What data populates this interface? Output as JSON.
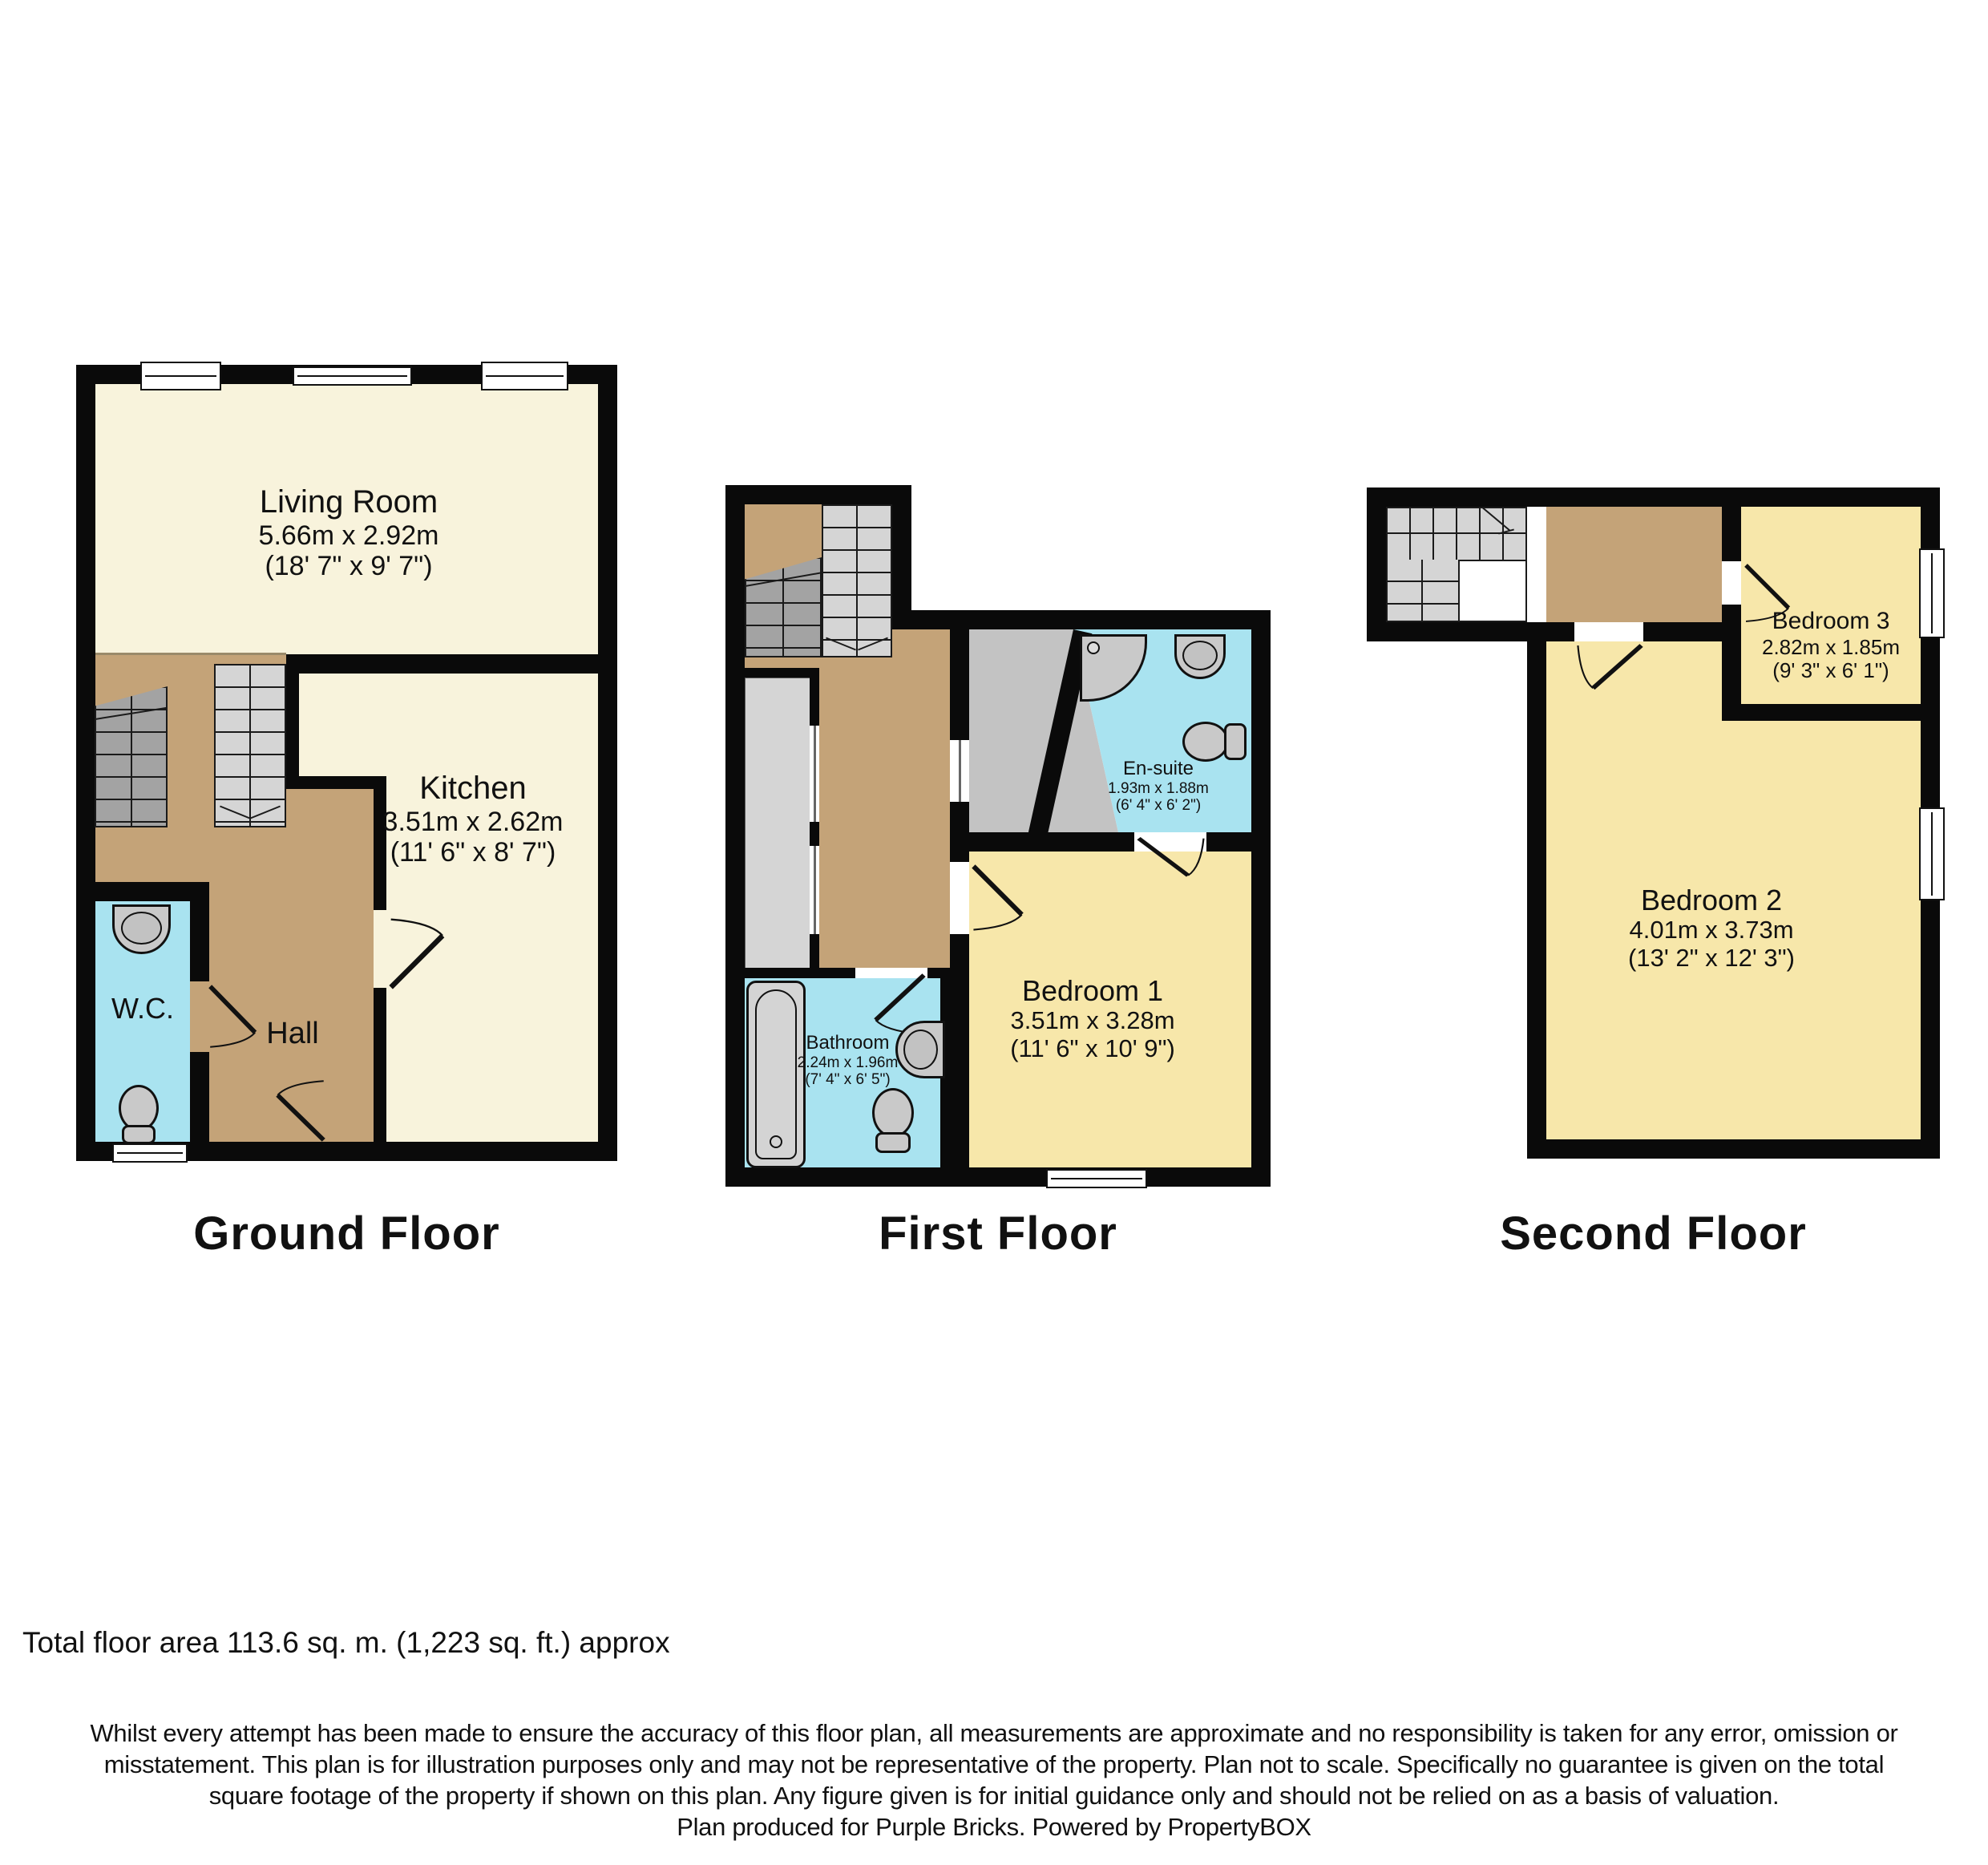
{
  "colors": {
    "wall": "#0a0a0a",
    "cream": "#F8F3DC",
    "yellow": "#F7E7AA",
    "brown": "#C4A378",
    "cyan": "#A9E3F0",
    "gray_light": "#D5D5D5",
    "gray_mid": "#C3C3C3",
    "gray_dark": "#A3A3A3",
    "fixture": "#C9C9C9"
  },
  "ground": {
    "title": "Ground Floor",
    "living": {
      "name": "Living Room",
      "m": "5.66m x 2.92m",
      "ft": "(18' 7\" x 9' 7\")"
    },
    "kitchen": {
      "name": "Kitchen",
      "m": "3.51m x 2.62m",
      "ft": "(11' 6\" x 8' 7\")"
    },
    "wc": {
      "name": "W.C."
    },
    "hall": {
      "name": "Hall"
    }
  },
  "first": {
    "title": "First Floor",
    "ensuite": {
      "name": "En-suite",
      "m": "1.93m x 1.88m",
      "ft": "(6' 4\" x 6' 2\")"
    },
    "bed1": {
      "name": "Bedroom 1",
      "m": "3.51m x 3.28m",
      "ft": "(11' 6\" x 10' 9\")"
    },
    "bath": {
      "name": "Bathroom",
      "m": "2.24m x 1.96m",
      "ft": "(7' 4\" x 6' 5\")"
    }
  },
  "second": {
    "title": "Second Floor",
    "bed3": {
      "name": "Bedroom 3",
      "m": "2.82m x 1.85m",
      "ft": "(9' 3\" x 6' 1\")"
    },
    "bed2": {
      "name": "Bedroom 2",
      "m": "4.01m x 3.73m",
      "ft": "(13' 2\" x 12' 3\")"
    }
  },
  "footer": {
    "total_area": "Total floor area 113.6 sq. m. (1,223 sq. ft.) approx",
    "disclaimer_lines": [
      "Whilst every attempt has been made to ensure the accuracy of this floor plan, all measurements are approximate and no responsibility is taken for any error, omission or",
      "misstatement. This plan is for illustration purposes only and may not be representative of the property. Plan not to scale. Specifically no guarantee is given on the total",
      "square footage of the property if shown on this plan. Any figure given is for initial guidance only and should not be relied on as a basis of valuation.",
      "Plan produced for Purple Bricks. Powered by PropertyBOX"
    ]
  }
}
